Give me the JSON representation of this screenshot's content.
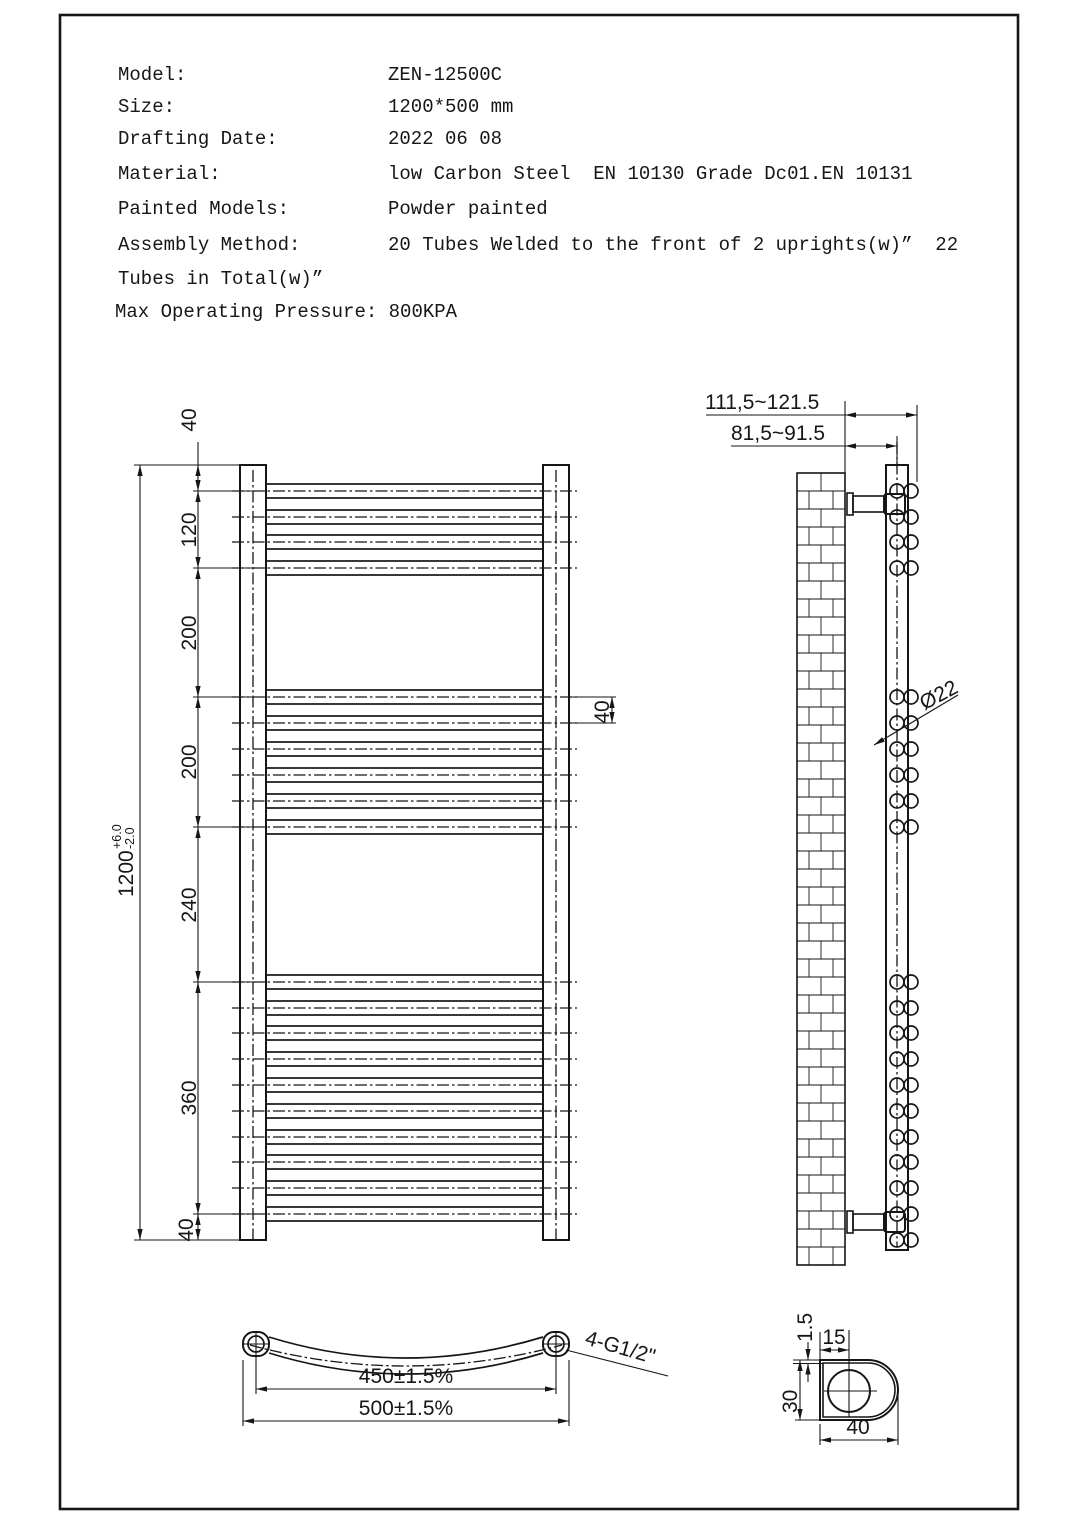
{
  "header": {
    "rows": [
      {
        "label": "Model:",
        "value": "ZEN-12500C"
      },
      {
        "label": "Size:",
        "value": "1200*500 mm"
      },
      {
        "label": "Drafting Date:",
        "value": "2022 06 08"
      },
      {
        "label": "Material:",
        "value": "low Carbon Steel  EN 10130 Grade Dc01.EN 10131"
      },
      {
        "label": "Painted Models:",
        "value": "Powder painted"
      },
      {
        "label": "Assembly Method:",
        "value": "20 Tubes Welded to the front of 2 uprights(w)”  22"
      }
    ],
    "overflow_line": "Tubes in Total(w)”",
    "pressure_line": "Max Operating Pressure: 800KPA"
  },
  "front_view": {
    "seg_top": "40",
    "seg_1": "120",
    "seg_2": "200",
    "seg_3": "200",
    "seg_4": "240",
    "seg_5": "360",
    "seg_bottom": "40",
    "tube_pitch": "40",
    "overall": "1200",
    "tol_plus": "+6.0",
    "tol_minus": "-2.0"
  },
  "side_view": {
    "dim_outer": "111,5~121.5",
    "dim_inner": "81,5~91.5",
    "tube_dia": "Ø22"
  },
  "top_view": {
    "dim_centers": "450±1.5%",
    "dim_overall": "500±1.5%",
    "thread_label": "4-G1/2\""
  },
  "detail_view": {
    "wall_thickness": "1.5",
    "hole_offset": "15",
    "profile_height": "30",
    "profile_width": "40"
  },
  "colors": {
    "ink": "#161616",
    "paper": "#ffffff"
  }
}
